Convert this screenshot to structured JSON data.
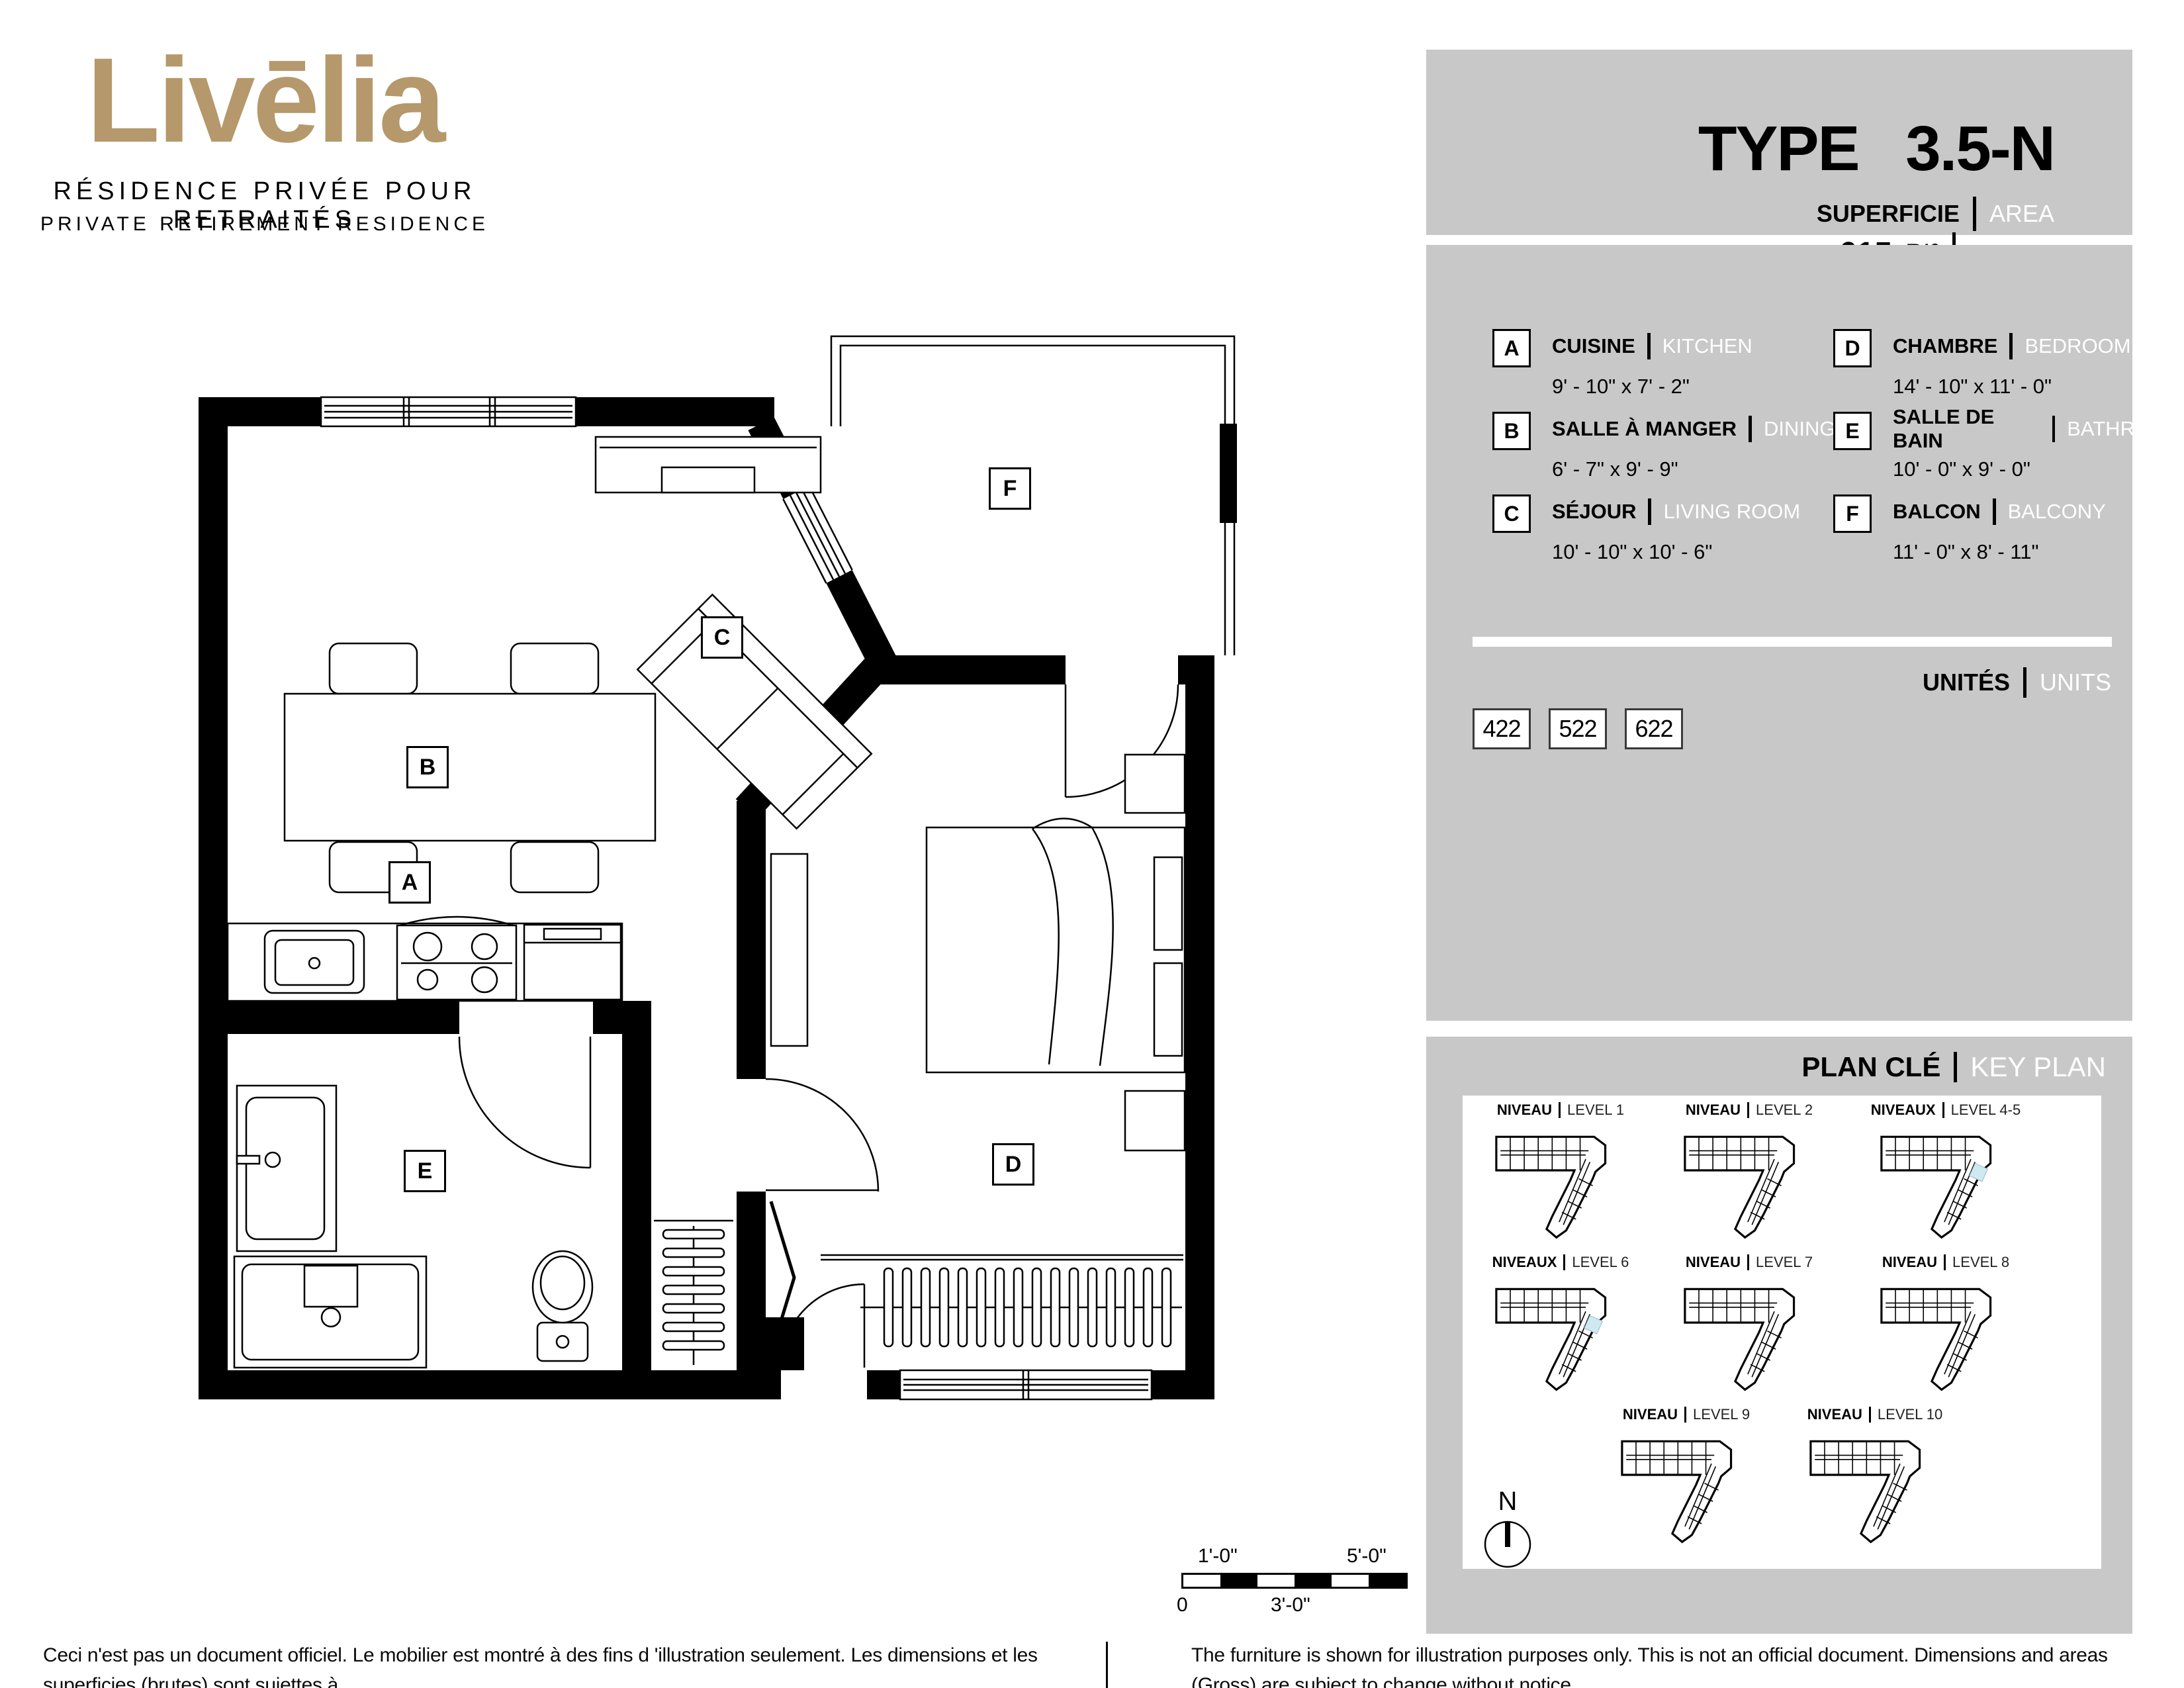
{
  "brand": {
    "name": "Livēlia",
    "tagline_fr": "RÉSIDENCE PRIVÉE POUR RETRAITÉS",
    "tagline_en": "PRIVATE RETIREMENT RESIDENCE"
  },
  "header": {
    "title": "TYPE 3.5-N",
    "area_label_fr": "SUPERFICIE",
    "area_label_en": "AREA",
    "area_value": "615",
    "area_unit_fr": "PI²",
    "area_unit_en": "SQ. FT"
  },
  "legend": {
    "items": [
      {
        "letter": "A",
        "name_fr": "CUISINE",
        "name_en": "KITCHEN",
        "dims": "9' - 10\" x 7' - 2\""
      },
      {
        "letter": "B",
        "name_fr": "SALLE À MANGER",
        "name_en": "DINING",
        "dims": "6' - 7\" x 9' - 9\""
      },
      {
        "letter": "C",
        "name_fr": "SÉJOUR",
        "name_en": "LIVING ROOM",
        "dims": "10' - 10\" x 10' - 6\""
      },
      {
        "letter": "D",
        "name_fr": "CHAMBRE",
        "name_en": "BEDROOM",
        "dims": "14' - 10\" x 11' - 0\""
      },
      {
        "letter": "E",
        "name_fr": "SALLE DE BAIN",
        "name_en": "BATHROOM",
        "dims": "10' - 0\" x 9' - 0\""
      },
      {
        "letter": "F",
        "name_fr": "BALCON",
        "name_en": "BALCONY",
        "dims": "11' - 0\" x 8' - 11\""
      }
    ]
  },
  "units": {
    "title_fr": "UNITÉS",
    "title_en": "UNITS",
    "numbers": [
      "422",
      "522",
      "622"
    ]
  },
  "key_plan": {
    "title_fr": "PLAN CLÉ",
    "title_en": "KEY PLAN",
    "north_label": "N",
    "levels": [
      {
        "label_fr": "NIVEAU",
        "label_en": "LEVEL 1",
        "highlighted": false
      },
      {
        "label_fr": "NIVEAU",
        "label_en": "LEVEL 2",
        "highlighted": false
      },
      {
        "label_fr": "NIVEAUX",
        "label_en": "LEVEL 4-5",
        "highlighted": true
      },
      {
        "label_fr": "NIVEAUX",
        "label_en": "LEVEL 6",
        "highlighted": true
      },
      {
        "label_fr": "NIVEAU",
        "label_en": "LEVEL 7",
        "highlighted": false
      },
      {
        "label_fr": "NIVEAU",
        "label_en": "LEVEL 8",
        "highlighted": false
      },
      {
        "label_fr": "NIVEAU",
        "label_en": "LEVEL 9",
        "highlighted": false
      },
      {
        "label_fr": "NIVEAU",
        "label_en": "LEVEL 10",
        "highlighted": false
      }
    ]
  },
  "plan": {
    "labels": {
      "a": "A",
      "b": "B",
      "c": "C",
      "d": "D",
      "e": "E",
      "f": "F"
    }
  },
  "scale_bar": {
    "mark_1": "1'-0\"",
    "mark_5": "5'-0\"",
    "zero": "0",
    "mark_3": "3'-0\""
  },
  "footer": {
    "fr_line1": "Ceci n'est pas un document officiel.  Le mobilier est montré à des fins d 'illustration seulement.  Les dimensions et les superficies (brutes) sont sujettes à",
    "fr_line2": "changement sans préavis. La superficie et la position des éléments structuraux peuvent varier en fonction de l'emplacement de l'unité dans le bâtiment.",
    "en_line1": "The furniture is shown for illustration purposes only.  This is not an official document.  Dimensions and areas (Gross) are subject to change without notice.",
    "en_line2": "Area and position of structural elements may vary depending of location of unit in building."
  },
  "colors": {
    "gold": "#b5986b",
    "gray": "#c8c8c8",
    "highlight": "#cfe9f0"
  }
}
